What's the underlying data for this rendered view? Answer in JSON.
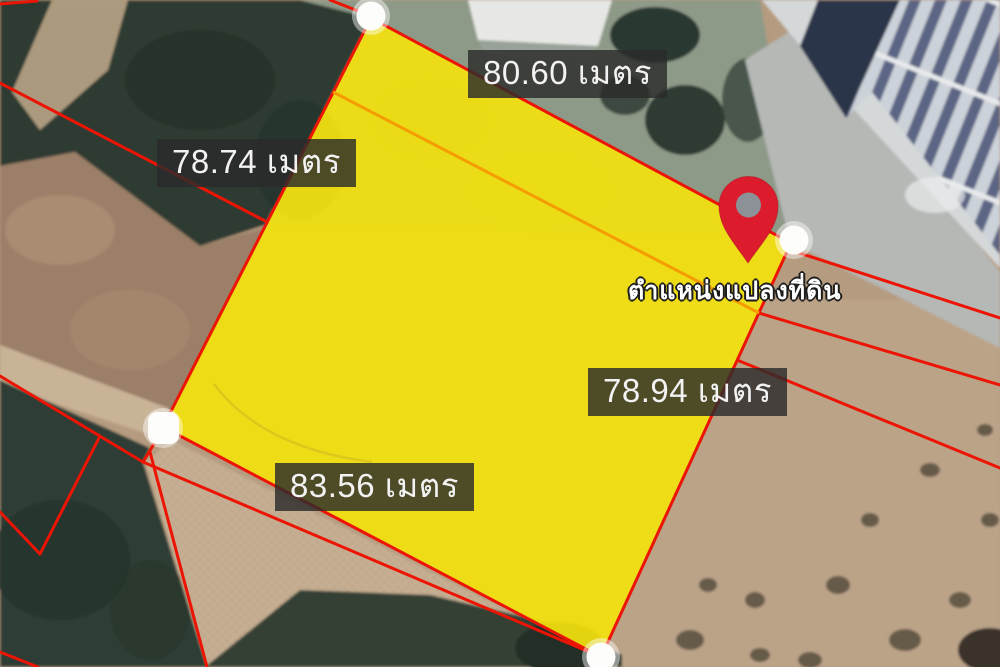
{
  "map": {
    "parcel": {
      "fill_color": "#f2e10e",
      "outline_color": "#ec1404",
      "side_labels": {
        "top": "80.60 เมตร",
        "left": "78.74 เมตร",
        "right": "78.94 เมตร",
        "bottom": "83.56 เมตร"
      },
      "corner_marker_color": "#ffffff",
      "corner_marker_count": 4
    },
    "pin": {
      "color": "#dc1b2d",
      "label": "ตำแหน่งแปลงที่ดิน"
    },
    "cadastral_line_color": "#ec1404",
    "crossing_line_color": "#f59d00",
    "label_style": {
      "background": "rgba(43,43,43,0.82)",
      "text_color": "#f2f2f2"
    }
  }
}
